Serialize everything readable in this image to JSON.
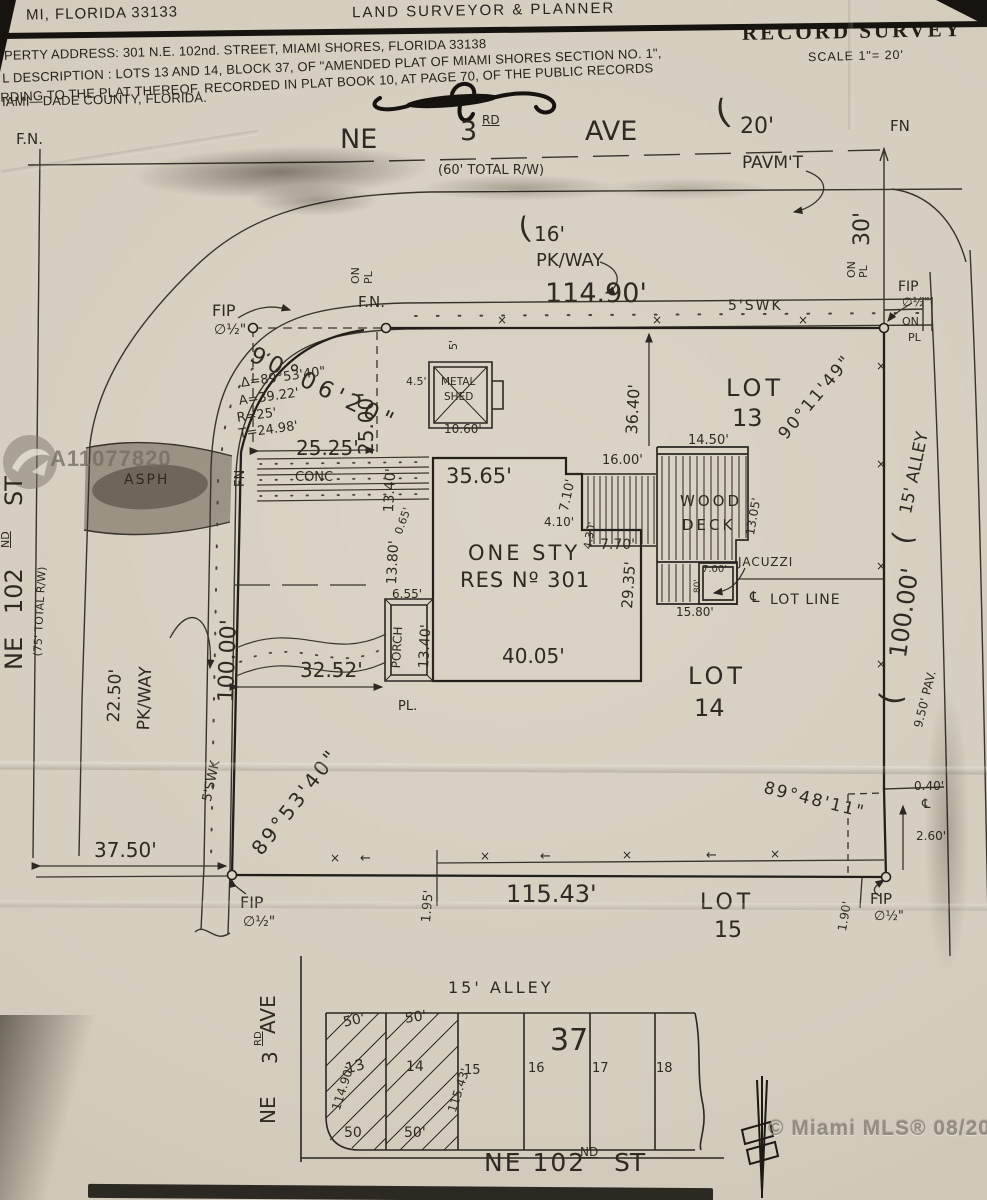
{
  "header": {
    "address_left": "MI, FLORIDA 33133",
    "firm_title": "LAND SURVEYOR  &  PLANNER",
    "record_survey": "RECORD SURVEY",
    "scale": "SCALE 1\"= 20'",
    "line1": "PERTY ADDRESS: 301 N.E. 102nd. STREET, MIAMI SHORES, FLORIDA 33138",
    "line2": "L DESCRIPTION : LOTS 13 AND 14, BLOCK 37, OF \"AMENDED PLAT OF MIAMI SHORES SECTION NO. 1\",",
    "line3": "RDING TO THE PLAT THEREOF, RECORDED IN PLAT BOOK 10, AT PAGE 70, OF THE PUBLIC RECORDS",
    "line4": "IAMI—DADE COUNTY, FLORIDA."
  },
  "watermarks": {
    "mls_id": "A11077820",
    "mls_credit": "© Miami MLS® 08/2021"
  },
  "survey_labels": [
    {
      "t": "F.N.",
      "x": 16,
      "y": 132,
      "fs": 15
    },
    {
      "t": "NE",
      "x": 340,
      "y": 126,
      "fs": 27
    },
    {
      "t": "3",
      "x": 460,
      "y": 118,
      "fs": 27
    },
    {
      "t": "RD",
      "x": 482,
      "y": 114,
      "fs": 12,
      "cls": "hd sup"
    },
    {
      "t": "AVE",
      "x": 585,
      "y": 118,
      "fs": 27
    },
    {
      "t": "(60' TOTAL R/W)",
      "x": 438,
      "y": 164,
      "fs": 13
    },
    {
      "t": "(",
      "x": 712,
      "y": 98,
      "fs": 34,
      "r": -15
    },
    {
      "t": "20'",
      "x": 740,
      "y": 116,
      "fs": 22
    },
    {
      "t": "PAVM'T",
      "x": 742,
      "y": 155,
      "fs": 17
    },
    {
      "t": "FN",
      "x": 890,
      "y": 119,
      "fs": 15
    },
    {
      "t": "(",
      "x": 516,
      "y": 216,
      "fs": 30,
      "r": -12
    },
    {
      "t": "16'",
      "x": 534,
      "y": 224,
      "fs": 20
    },
    {
      "t": "PK/WAY",
      "x": 536,
      "y": 252,
      "fs": 18
    },
    {
      "t": "ON",
      "x": 350,
      "y": 284,
      "r": -90,
      "fs": 11
    },
    {
      "t": "PL",
      "x": 363,
      "y": 284,
      "r": -90,
      "fs": 11
    },
    {
      "t": "F.N.",
      "x": 358,
      "y": 295,
      "fs": 15
    },
    {
      "t": "114.90'",
      "x": 545,
      "y": 280,
      "fs": 27
    },
    {
      "t": "5'SWK",
      "x": 728,
      "y": 299,
      "fs": 14,
      "ls": 2
    },
    {
      "t": "FIP",
      "x": 212,
      "y": 303,
      "fs": 16
    },
    {
      "t": "∅½\"",
      "x": 214,
      "y": 323,
      "fs": 14
    },
    {
      "t": "90°06'20\"",
      "x": 256,
      "y": 344,
      "r": 26,
      "fs": 23,
      "ls": 5
    },
    {
      "t": "Δ=89°53'40\"",
      "x": 240,
      "y": 377,
      "r": -8,
      "fs": 13
    },
    {
      "t": "A=39.22'",
      "x": 238,
      "y": 395,
      "r": -8,
      "fs": 13
    },
    {
      "t": "R=25'",
      "x": 236,
      "y": 412,
      "r": -8,
      "fs": 13
    },
    {
      "t": "T=24.98'",
      "x": 238,
      "y": 428,
      "r": -8,
      "fs": 13
    },
    {
      "t": "25.00'",
      "x": 356,
      "y": 455,
      "r": -90,
      "fs": 20
    },
    {
      "t": "25.25'",
      "x": 296,
      "y": 438,
      "fs": 20
    },
    {
      "t": "FN",
      "x": 234,
      "y": 487,
      "r": -90,
      "fs": 13
    },
    {
      "t": "CONC",
      "x": 295,
      "y": 471,
      "fs": 13
    },
    {
      "t": "ASPH",
      "x": 124,
      "y": 473,
      "fs": 14,
      "ls": 2
    },
    {
      "t": "5'",
      "x": 448,
      "y": 350,
      "r": -90,
      "fs": 11
    },
    {
      "t": "4.5'",
      "x": 406,
      "y": 376,
      "fs": 11
    },
    {
      "t": "METAL",
      "x": 441,
      "y": 377,
      "fs": 10.5
    },
    {
      "t": "SHED",
      "x": 444,
      "y": 392,
      "fs": 10.5
    },
    {
      "t": "10.60'",
      "x": 444,
      "y": 423,
      "fs": 12
    },
    {
      "t": "35.65'",
      "x": 446,
      "y": 466,
      "fs": 21
    },
    {
      "t": "7.10'",
      "x": 558,
      "y": 510,
      "r": -78,
      "fs": 13
    },
    {
      "t": "16.00'",
      "x": 602,
      "y": 454,
      "fs": 13
    },
    {
      "t": "4.10'",
      "x": 544,
      "y": 516,
      "fs": 12
    },
    {
      "t": "4.30'",
      "x": 582,
      "y": 548,
      "r": -80,
      "fs": 11
    },
    {
      "t": "7.70'",
      "x": 600,
      "y": 538,
      "fs": 14
    },
    {
      "t": "14.50'",
      "x": 688,
      "y": 434,
      "fs": 13
    },
    {
      "t": "WOOD",
      "x": 680,
      "y": 494,
      "fs": 15,
      "ls": 3
    },
    {
      "t": "DECK",
      "x": 682,
      "y": 518,
      "fs": 15,
      "ls": 3
    },
    {
      "t": "13.05'",
      "x": 744,
      "y": 534,
      "r": -80,
      "fs": 12
    },
    {
      "t": "36.40'",
      "x": 624,
      "y": 434,
      "r": -87,
      "fs": 16
    },
    {
      "t": "LOT",
      "x": 726,
      "y": 376,
      "fs": 24,
      "ls": 4
    },
    {
      "t": "13",
      "x": 732,
      "y": 406,
      "fs": 24
    },
    {
      "t": "90°11'49\"",
      "x": 776,
      "y": 432,
      "r": -50,
      "fs": 17,
      "ls": 2
    },
    {
      "t": "ONE STY",
      "x": 468,
      "y": 543,
      "fs": 21,
      "ls": 3
    },
    {
      "t": "RES Nº 301",
      "x": 460,
      "y": 570,
      "fs": 21,
      "ls": 1
    },
    {
      "t": "29.35'",
      "x": 620,
      "y": 608,
      "r": -86,
      "fs": 15
    },
    {
      "t": "JACUZZI",
      "x": 738,
      "y": 556,
      "fs": 12,
      "ls": 1
    },
    {
      "t": "7.00'",
      "x": 702,
      "y": 565,
      "fs": 10
    },
    {
      "t": ".80'",
      "x": 694,
      "y": 596,
      "r": -90,
      "fs": 9
    },
    {
      "t": "℄",
      "x": 750,
      "y": 590,
      "fs": 15
    },
    {
      "t": "LOT LINE",
      "x": 770,
      "y": 593,
      "fs": 14,
      "ls": 1
    },
    {
      "t": "15.80'",
      "x": 676,
      "y": 606,
      "fs": 12
    },
    {
      "t": "40.05'",
      "x": 502,
      "y": 646,
      "fs": 20
    },
    {
      "t": "LOT",
      "x": 688,
      "y": 664,
      "fs": 24,
      "ls": 4
    },
    {
      "t": "14",
      "x": 694,
      "y": 696,
      "fs": 24
    },
    {
      "t": "13.40'",
      "x": 382,
      "y": 512,
      "r": -87,
      "fs": 14
    },
    {
      "t": "0.65'",
      "x": 393,
      "y": 532,
      "r": -70,
      "fs": 11
    },
    {
      "t": "13.80'",
      "x": 385,
      "y": 584,
      "r": -87,
      "fs": 14
    },
    {
      "t": "6.55'",
      "x": 392,
      "y": 588,
      "fs": 12
    },
    {
      "t": "PORCH",
      "x": 390,
      "y": 668,
      "r": -87,
      "fs": 12
    },
    {
      "t": "13.40'",
      "x": 417,
      "y": 668,
      "r": -87,
      "fs": 14
    },
    {
      "t": "32.52'",
      "x": 300,
      "y": 660,
      "fs": 20
    },
    {
      "t": "PL.",
      "x": 398,
      "y": 700,
      "fs": 13
    },
    {
      "t": "100.00'",
      "x": 216,
      "y": 702,
      "r": -88,
      "fs": 22
    },
    {
      "t": "5'SWK",
      "x": 201,
      "y": 800,
      "r": -78,
      "fs": 13
    },
    {
      "t": "22.50'",
      "x": 106,
      "y": 722,
      "r": -88,
      "fs": 17
    },
    {
      "t": "PK/WAY",
      "x": 136,
      "y": 730,
      "r": -88,
      "fs": 17
    },
    {
      "t": "ST",
      "x": 2,
      "y": 506,
      "r": -90,
      "fs": 24
    },
    {
      "t": "ND",
      "x": 0,
      "y": 548,
      "r": -90,
      "fs": 11,
      "cls": "hd sup"
    },
    {
      "t": "102",
      "x": 2,
      "y": 614,
      "r": -90,
      "fs": 24
    },
    {
      "t": "NE",
      "x": 2,
      "y": 670,
      "r": -90,
      "fs": 24
    },
    {
      "t": "(75' TOTAL R/W)",
      "x": 32,
      "y": 656,
      "r": -87,
      "fs": 11
    },
    {
      "t": "37.50'",
      "x": 94,
      "y": 840,
      "fs": 20
    },
    {
      "t": "89°53'40\"",
      "x": 248,
      "y": 846,
      "r": -52,
      "fs": 20,
      "ls": 3
    },
    {
      "t": "FIP",
      "x": 240,
      "y": 895,
      "fs": 16
    },
    {
      "t": "∅½\"",
      "x": 243,
      "y": 915,
      "fs": 14
    },
    {
      "t": "1.95'",
      "x": 420,
      "y": 922,
      "r": -85,
      "fs": 13
    },
    {
      "t": "115.43'",
      "x": 506,
      "y": 882,
      "fs": 24
    },
    {
      "t": "LOT",
      "x": 700,
      "y": 892,
      "fs": 22,
      "ls": 4
    },
    {
      "t": "15",
      "x": 714,
      "y": 920,
      "fs": 22
    },
    {
      "t": "89°48'11\"",
      "x": 766,
      "y": 780,
      "r": 14,
      "fs": 17,
      "ls": 2
    },
    {
      "t": "0.40'",
      "x": 914,
      "y": 780,
      "fs": 12
    },
    {
      "t": "℄",
      "x": 922,
      "y": 798,
      "fs": 13
    },
    {
      "t": "2.60'",
      "x": 916,
      "y": 830,
      "fs": 12
    },
    {
      "t": "1.90'",
      "x": 836,
      "y": 930,
      "r": -80,
      "fs": 12
    },
    {
      "t": "FIP",
      "x": 870,
      "y": 892,
      "fs": 15
    },
    {
      "t": "∅½\"",
      "x": 874,
      "y": 910,
      "fs": 13
    },
    {
      "t": "30'",
      "x": 852,
      "y": 246,
      "r": -90,
      "fs": 22
    },
    {
      "t": "ON",
      "x": 846,
      "y": 278,
      "r": -90,
      "fs": 11
    },
    {
      "t": "PL",
      "x": 858,
      "y": 278,
      "r": -90,
      "fs": 11
    },
    {
      "t": "FIP",
      "x": 898,
      "y": 280,
      "fs": 14
    },
    {
      "t": "∅½\"",
      "x": 902,
      "y": 296,
      "fs": 12
    },
    {
      "t": "ON",
      "x": 902,
      "y": 316,
      "fs": 11
    },
    {
      "t": "PL",
      "x": 908,
      "y": 332,
      "fs": 11
    },
    {
      "t": "(",
      "x": 888,
      "y": 540,
      "r": -75,
      "fs": 28
    },
    {
      "t": "15' ALLEY",
      "x": 898,
      "y": 512,
      "r": -78,
      "fs": 17
    },
    {
      "t": "(",
      "x": 876,
      "y": 702,
      "r": -80,
      "fs": 30
    },
    {
      "t": "100.00'",
      "x": 886,
      "y": 656,
      "r": -82,
      "fs": 24
    },
    {
      "t": "9.50' PAV.",
      "x": 912,
      "y": 726,
      "r": -76,
      "fs": 12
    },
    {
      "t": "×",
      "x": 497,
      "y": 314,
      "fs": 12
    },
    {
      "t": "×",
      "x": 652,
      "y": 314,
      "fs": 12
    },
    {
      "t": "×",
      "x": 798,
      "y": 314,
      "fs": 12
    },
    {
      "t": "×",
      "x": 330,
      "y": 852,
      "fs": 12
    },
    {
      "t": "×",
      "x": 480,
      "y": 850,
      "fs": 12
    },
    {
      "t": "×",
      "x": 622,
      "y": 849,
      "fs": 12
    },
    {
      "t": "×",
      "x": 770,
      "y": 848,
      "fs": 12
    },
    {
      "t": "←",
      "x": 360,
      "y": 852,
      "fs": 13
    },
    {
      "t": "←",
      "x": 540,
      "y": 850,
      "fs": 13
    },
    {
      "t": "←",
      "x": 706,
      "y": 849,
      "fs": 13
    },
    {
      "t": "×",
      "x": 876,
      "y": 360,
      "fs": 12
    },
    {
      "t": "×",
      "x": 876,
      "y": 458,
      "fs": 12
    },
    {
      "t": "×",
      "x": 876,
      "y": 560,
      "fs": 12
    },
    {
      "t": "×",
      "x": 876,
      "y": 658,
      "fs": 12
    },
    {
      "t": "15'  ALLEY",
      "x": 448,
      "y": 980,
      "fs": 16,
      "ls": 3
    },
    {
      "t": "50'",
      "x": 342,
      "y": 1016,
      "r": -12,
      "fs": 14
    },
    {
      "t": "50'",
      "x": 404,
      "y": 1012,
      "r": -8,
      "fs": 14
    },
    {
      "t": "50",
      "x": 344,
      "y": 1126,
      "fs": 14
    },
    {
      "t": "50'",
      "x": 404,
      "y": 1126,
      "fs": 14
    },
    {
      "t": "37",
      "x": 550,
      "y": 1026,
      "fs": 30
    },
    {
      "t": "13",
      "x": 344,
      "y": 1062,
      "r": -15,
      "fs": 15
    },
    {
      "t": "14",
      "x": 406,
      "y": 1060,
      "fs": 14
    },
    {
      "t": "15",
      "x": 464,
      "y": 1064,
      "fs": 13
    },
    {
      "t": "16",
      "x": 528,
      "y": 1062,
      "fs": 13
    },
    {
      "t": "17",
      "x": 592,
      "y": 1062,
      "fs": 13
    },
    {
      "t": "18",
      "x": 656,
      "y": 1062,
      "fs": 13
    },
    {
      "t": "114.90'",
      "x": 330,
      "y": 1108,
      "r": -72,
      "fs": 12
    },
    {
      "t": "115.43'",
      "x": 446,
      "y": 1110,
      "r": -72,
      "fs": 12
    },
    {
      "t": "AVE",
      "x": 258,
      "y": 1034,
      "r": -90,
      "fs": 20
    },
    {
      "t": "RD",
      "x": 254,
      "y": 1046,
      "r": -90,
      "fs": 10,
      "cls": "hd sup"
    },
    {
      "t": "3",
      "x": 260,
      "y": 1064,
      "r": -90,
      "fs": 20
    },
    {
      "t": "NE",
      "x": 258,
      "y": 1124,
      "r": -90,
      "fs": 20
    },
    {
      "t": "NE 102",
      "x": 484,
      "y": 1150,
      "fs": 25,
      "ls": 2
    },
    {
      "t": "ND",
      "x": 580,
      "y": 1146,
      "fs": 12,
      "cls": "hd sup"
    },
    {
      "t": "ST",
      "x": 614,
      "y": 1150,
      "fs": 25
    },
    {
      "t": "A11077820",
      "x": 50,
      "y": 448,
      "fs": 22,
      "cls": "wm",
      "n": "mls-watermark-id"
    },
    {
      "t": "© Miami MLS® 08/2021",
      "x": 768,
      "y": 1118,
      "fs": 21,
      "cls": "wm2",
      "n": "mls-watermark-credit"
    }
  ]
}
